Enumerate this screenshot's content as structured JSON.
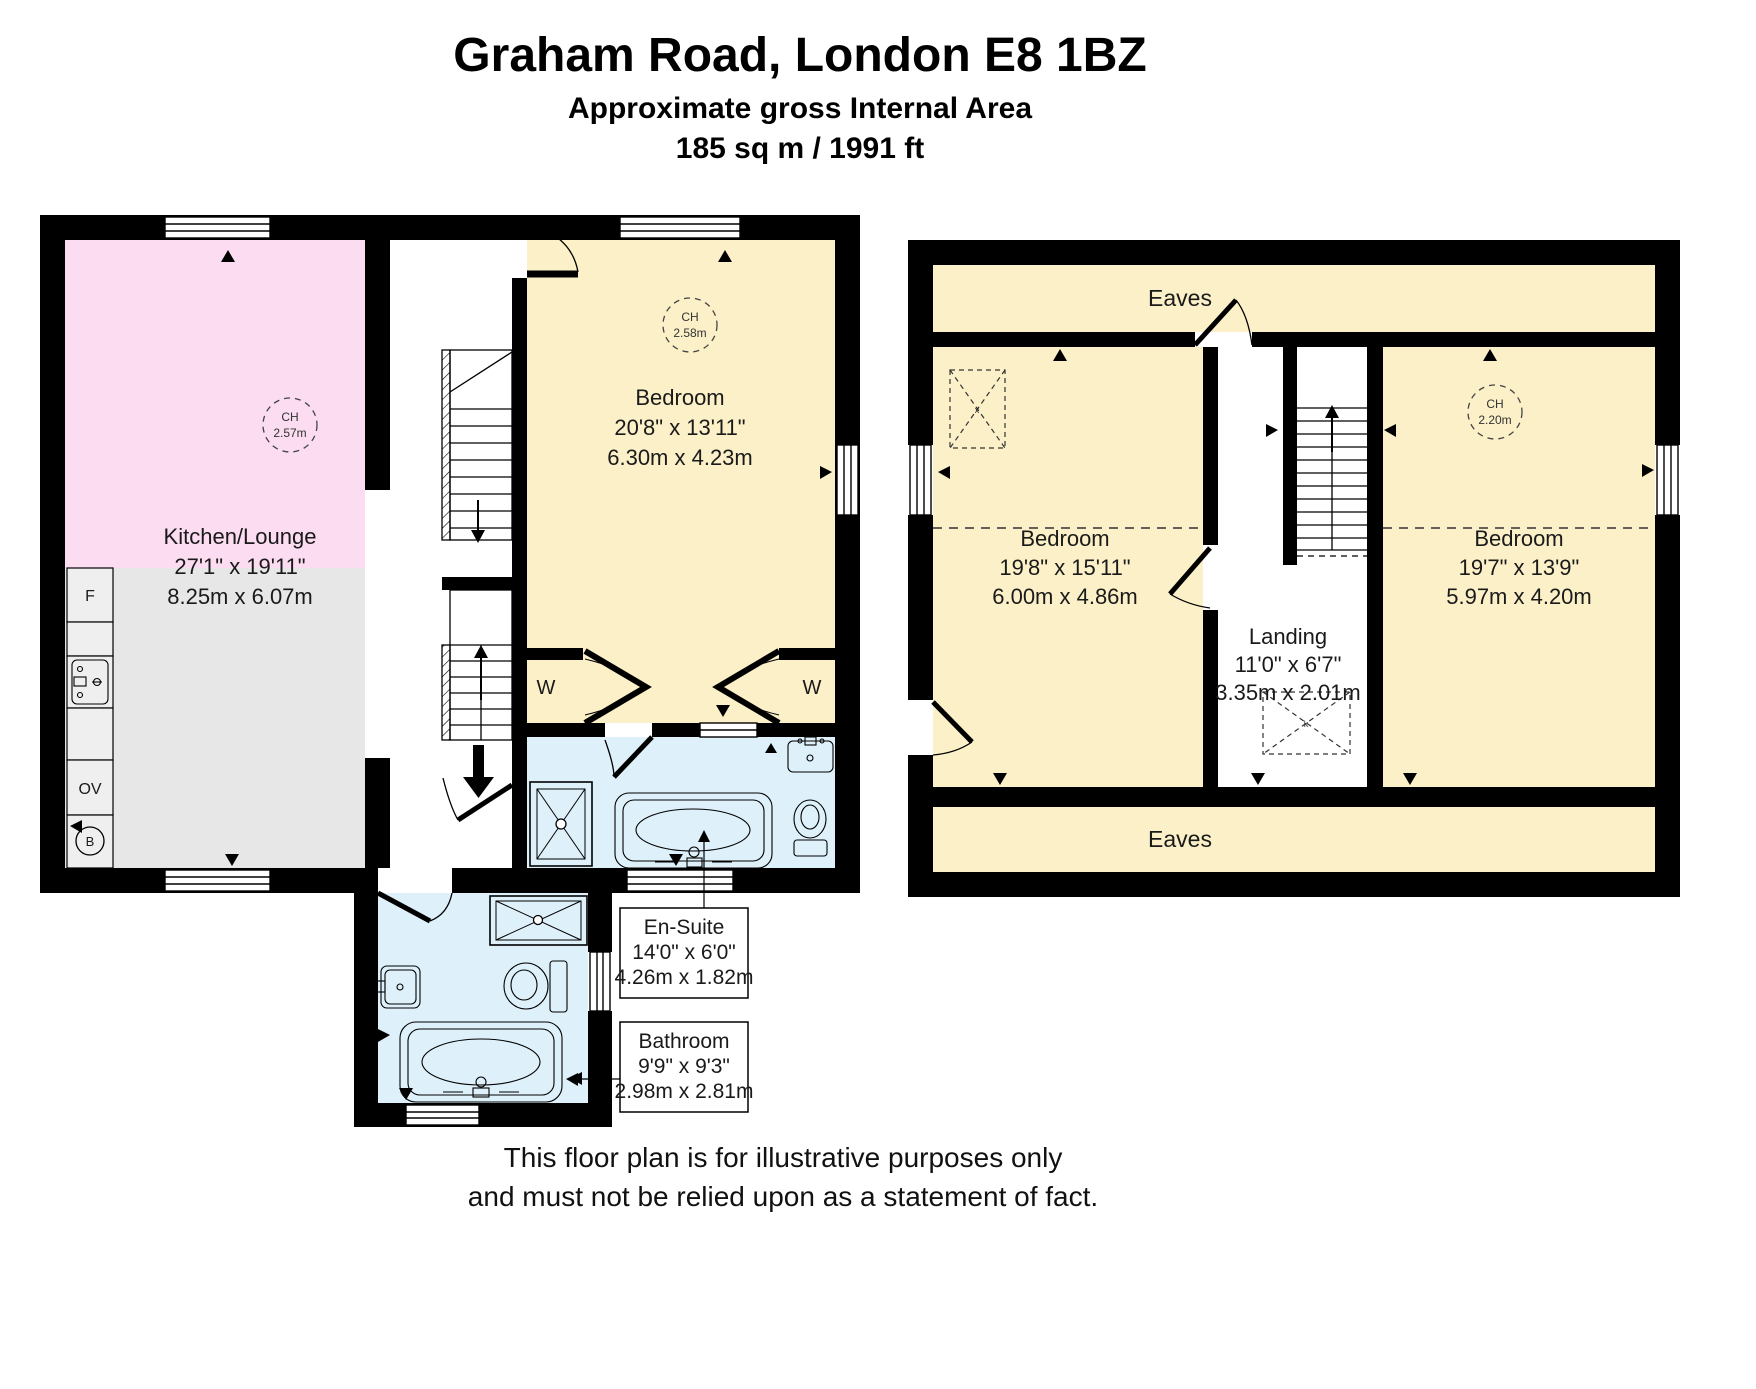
{
  "title": {
    "address": "Graham Road, London E8 1BZ",
    "subtitle": "Approximate gross Internal Area",
    "area": "185 sq m / 1991 ft"
  },
  "disclaimer": {
    "line1": "This floor plan is for illustrative purposes only",
    "line2": "and must not be relied upon as a statement of fact."
  },
  "colors": {
    "wall": "#000000",
    "room_pink": "#fbdcf0",
    "room_grey": "#e7e7e7",
    "room_yellow": "#fbf0c8",
    "room_blue": "#def0f9"
  },
  "ground_floor": {
    "kitchen_lounge": {
      "name": "Kitchen/Lounge",
      "imperial": "27'1\" x 19'11\"",
      "metric": "8.25m x 6.07m",
      "ch_label": "CH",
      "ch_value": "2.57m"
    },
    "bedroom": {
      "name": "Bedroom",
      "imperial": "20'8\" x 13'11\"",
      "metric": "6.30m x 4.23m",
      "ch_label": "CH",
      "ch_value": "2.58m"
    },
    "en_suite": {
      "name": "En-Suite",
      "imperial": "14'0\" x 6'0\"",
      "metric": "4.26m x 1.82m"
    },
    "bathroom": {
      "name": "Bathroom",
      "imperial": "9'9\" x 9'3\"",
      "metric": "2.98m x 2.81m"
    },
    "fixtures": {
      "fridge": "F",
      "oven": "OV",
      "boiler": "B",
      "wardrobe": "W"
    }
  },
  "first_floor": {
    "bedroom_left": {
      "name": "Bedroom",
      "imperial": "19'8\" x 15'11\"",
      "metric": "6.00m x 4.86m"
    },
    "bedroom_right": {
      "name": "Bedroom",
      "imperial": "19'7\" x 13'9\"",
      "metric": "5.97m x 4.20m",
      "ch_label": "CH",
      "ch_value": "2.20m"
    },
    "landing": {
      "name": "Landing",
      "imperial": "11'0\" x 6'7\"",
      "metric": "3.35m x 2.01m"
    },
    "eaves": "Eaves",
    "skylight_mark_x": "x",
    "skylight_mark_k": "k"
  }
}
